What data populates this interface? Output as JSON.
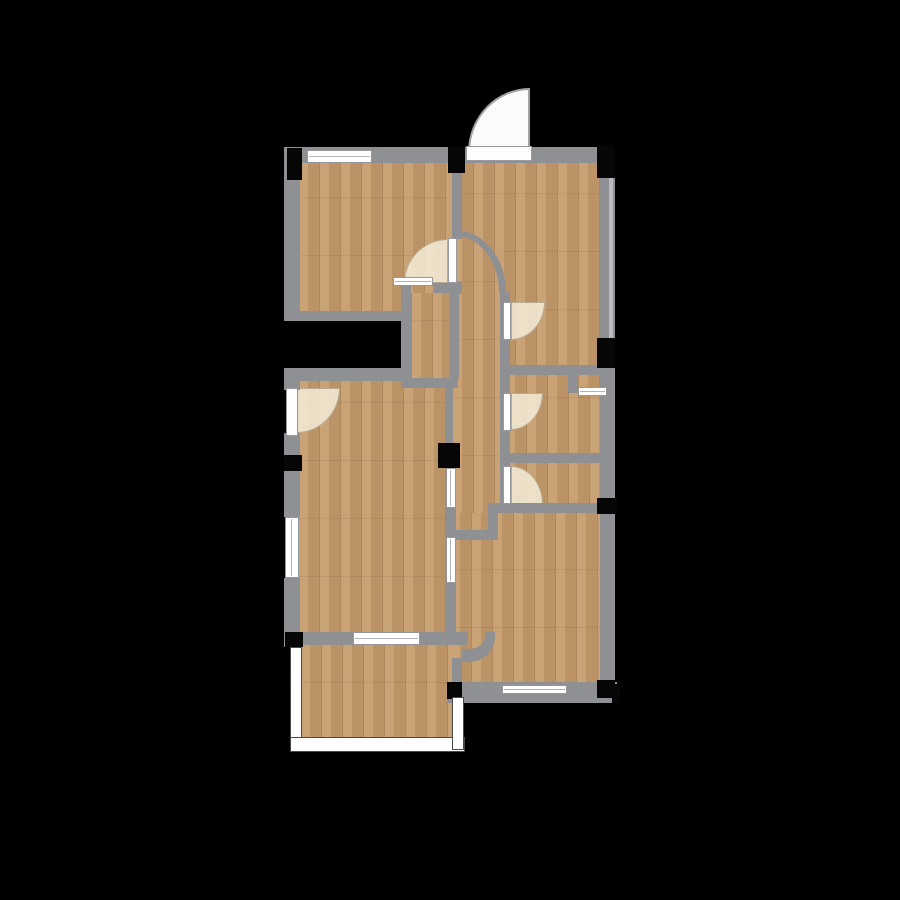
{
  "canvas": {
    "width": 900,
    "height": 900,
    "background": "#000000",
    "name": "floorplan-canvas"
  },
  "palette": {
    "floor_wood": "#c59b6c",
    "floor_plank_line": "#6e4824",
    "wall": "#8f9094",
    "wall_light": "#babbc1",
    "window_fill": "#ffffff",
    "window_frame": "#97979b",
    "door_leaf": "#fefefe",
    "door_swing": "#f3e9d5",
    "entry_swing": "#fbfbfb",
    "column": "#060607",
    "railing_fill": "#ffffff",
    "railing_edge": "#4a4a4a",
    "background": "#000000"
  },
  "floors": [
    {
      "name": "floor-room-top-left",
      "x": 298,
      "y": 163,
      "w": 154,
      "h": 150
    },
    {
      "name": "floor-room-top-right",
      "x": 452,
      "y": 163,
      "w": 150,
      "h": 204
    },
    {
      "name": "floor-closet-pocket",
      "x": 411,
      "y": 293,
      "w": 39,
      "h": 85
    },
    {
      "name": "floor-hallway",
      "x": 452,
      "y": 238,
      "w": 51,
      "h": 275
    },
    {
      "name": "floor-bath-upper",
      "x": 505,
      "y": 375,
      "w": 97,
      "h": 80
    },
    {
      "name": "floor-niche",
      "x": 578,
      "y": 373,
      "w": 26,
      "h": 16
    },
    {
      "name": "floor-bath-lower",
      "x": 505,
      "y": 462,
      "w": 97,
      "h": 41
    },
    {
      "name": "floor-living-room",
      "x": 298,
      "y": 380,
      "w": 150,
      "h": 254
    },
    {
      "name": "floor-bedroom-bottom",
      "x": 450,
      "y": 513,
      "w": 152,
      "h": 172
    },
    {
      "name": "floor-balcony",
      "x": 300,
      "y": 645,
      "w": 153,
      "h": 95
    }
  ],
  "door_swings": [
    {
      "name": "entry-door-swing",
      "x": 468,
      "y": 88,
      "w": 62,
      "h": 64,
      "corner": "tl",
      "variant": "white"
    },
    {
      "name": "door-swing-room-top-left",
      "x": 404,
      "y": 239,
      "w": 44,
      "h": 44,
      "corner": "tl"
    },
    {
      "name": "door-swing-hall-upper",
      "x": 511,
      "y": 302,
      "w": 34,
      "h": 38,
      "corner": "br"
    },
    {
      "name": "door-swing-bath-upper",
      "x": 511,
      "y": 393,
      "w": 32,
      "h": 37,
      "corner": "br"
    },
    {
      "name": "door-swing-bath-lower",
      "x": 511,
      "y": 466,
      "w": 32,
      "h": 38,
      "corner": "tr"
    },
    {
      "name": "door-swing-living-west",
      "x": 297,
      "y": 388,
      "w": 43,
      "h": 45,
      "corner": "br"
    }
  ],
  "arc_walls": [
    {
      "name": "curved-wall-hallway",
      "x": 455,
      "y": 230,
      "w": 51,
      "h": 62
    }
  ],
  "corner_arcs": [
    {
      "name": "curved-wall-corner-living",
      "x": 462,
      "y": 632,
      "w": 33,
      "h": 30
    }
  ],
  "walls": [
    {
      "name": "wall-top",
      "x": 284,
      "y": 147,
      "w": 323,
      "h": 16
    },
    {
      "name": "wall-left-upper",
      "x": 284,
      "y": 147,
      "w": 16,
      "h": 173
    },
    {
      "name": "wall-divider-upper",
      "x": 452,
      "y": 163,
      "w": 10,
      "h": 76
    },
    {
      "name": "wall-divider-lower",
      "x": 452,
      "y": 282,
      "w": 10,
      "h": 12
    },
    {
      "name": "wall-right",
      "x": 600,
      "y": 147,
      "w": 15,
      "h": 556
    },
    {
      "name": "wall-right-window-strip",
      "x": 609,
      "y": 178,
      "w": 4,
      "h": 160,
      "light": true
    },
    {
      "name": "wall-room-tl-bottom",
      "x": 284,
      "y": 311,
      "w": 126,
      "h": 10
    },
    {
      "name": "wall-pocket-left",
      "x": 401,
      "y": 283,
      "w": 10,
      "h": 105
    },
    {
      "name": "wall-pocket-top-stub",
      "x": 433,
      "y": 283,
      "w": 26,
      "h": 10
    },
    {
      "name": "wall-pocket-bottom",
      "x": 401,
      "y": 378,
      "w": 57,
      "h": 10
    },
    {
      "name": "wall-pocket-right",
      "x": 450,
      "y": 293,
      "w": 9,
      "h": 85
    },
    {
      "name": "wall-hallway-west",
      "x": 445,
      "y": 378,
      "w": 8,
      "h": 66
    },
    {
      "name": "wall-hallway-east",
      "x": 500,
      "y": 292,
      "w": 10,
      "h": 221
    },
    {
      "name": "wall-bath-top",
      "x": 510,
      "y": 365,
      "w": 97,
      "h": 10
    },
    {
      "name": "wall-niche-left",
      "x": 568,
      "y": 375,
      "w": 10,
      "h": 18
    },
    {
      "name": "wall-bath-divider",
      "x": 503,
      "y": 453,
      "w": 112,
      "h": 10
    },
    {
      "name": "wall-hallway-bottom",
      "x": 492,
      "y": 503,
      "w": 125,
      "h": 10
    },
    {
      "name": "wall-jog-vertical",
      "x": 488,
      "y": 503,
      "w": 10,
      "h": 32
    },
    {
      "name": "wall-jog-horizontal",
      "x": 452,
      "y": 530,
      "w": 46,
      "h": 10
    },
    {
      "name": "wall-westline-seg1",
      "x": 446,
      "y": 508,
      "w": 10,
      "h": 29
    },
    {
      "name": "wall-westline-seg2",
      "x": 446,
      "y": 583,
      "w": 10,
      "h": 49
    },
    {
      "name": "wall-living-top",
      "x": 284,
      "y": 368,
      "w": 127,
      "h": 13
    },
    {
      "name": "wall-living-west-a",
      "x": 284,
      "y": 368,
      "w": 16,
      "h": 22
    },
    {
      "name": "wall-living-west-b",
      "x": 284,
      "y": 433,
      "w": 16,
      "h": 84
    },
    {
      "name": "wall-living-west-c",
      "x": 284,
      "y": 578,
      "w": 16,
      "h": 69
    },
    {
      "name": "wall-living-bottom-a",
      "x": 298,
      "y": 632,
      "w": 55,
      "h": 13
    },
    {
      "name": "wall-living-bottom-b",
      "x": 420,
      "y": 632,
      "w": 48,
      "h": 13
    },
    {
      "name": "wall-balcony-right",
      "x": 452,
      "y": 658,
      "w": 10,
      "h": 27
    },
    {
      "name": "wall-bedroom-bottom-band",
      "x": 447,
      "y": 682,
      "w": 170,
      "h": 21
    }
  ],
  "windows": [
    {
      "name": "window-top",
      "x": 307,
      "y": 150,
      "w": 65,
      "h": 13
    },
    {
      "name": "window-pocket",
      "x": 393,
      "y": 277,
      "w": 40,
      "h": 9
    },
    {
      "name": "window-living-west",
      "x": 285,
      "y": 517,
      "w": 14,
      "h": 61
    },
    {
      "name": "window-living-south",
      "x": 353,
      "y": 632,
      "w": 67,
      "h": 13
    },
    {
      "name": "window-niche",
      "x": 578,
      "y": 387,
      "w": 29,
      "h": 9
    },
    {
      "name": "window-interior-a",
      "x": 446,
      "y": 468,
      "w": 10,
      "h": 40
    },
    {
      "name": "window-interior-b",
      "x": 446,
      "y": 537,
      "w": 10,
      "h": 46
    },
    {
      "name": "window-bedroom-south",
      "x": 502,
      "y": 685,
      "w": 65,
      "h": 9
    }
  ],
  "door_leaves": [
    {
      "name": "entry-door-leaf",
      "x": 466,
      "y": 146,
      "w": 66,
      "h": 15
    },
    {
      "name": "door-leaf-room-top-left",
      "x": 448,
      "y": 238,
      "w": 9,
      "h": 45
    },
    {
      "name": "door-leaf-hall-upper",
      "x": 503,
      "y": 302,
      "w": 8,
      "h": 38
    },
    {
      "name": "door-leaf-bath-upper",
      "x": 503,
      "y": 393,
      "w": 8,
      "h": 38
    },
    {
      "name": "door-leaf-bath-lower",
      "x": 503,
      "y": 466,
      "w": 8,
      "h": 38
    },
    {
      "name": "door-leaf-living-west",
      "x": 286,
      "y": 388,
      "w": 12,
      "h": 48
    }
  ],
  "columns": [
    {
      "name": "column-top-left",
      "x": 287,
      "y": 148,
      "w": 15,
      "h": 32
    },
    {
      "name": "column-top-mid",
      "x": 448,
      "y": 147,
      "w": 17,
      "h": 26
    },
    {
      "name": "column-top-right",
      "x": 597,
      "y": 145,
      "w": 18,
      "h": 33
    },
    {
      "name": "column-right-mid",
      "x": 597,
      "y": 338,
      "w": 18,
      "h": 30
    },
    {
      "name": "column-right-lower",
      "x": 597,
      "y": 498,
      "w": 20,
      "h": 16
    },
    {
      "name": "column-center",
      "x": 438,
      "y": 443,
      "w": 22,
      "h": 25
    },
    {
      "name": "column-left-mid",
      "x": 284,
      "y": 455,
      "w": 18,
      "h": 16
    },
    {
      "name": "column-left-lower",
      "x": 285,
      "y": 632,
      "w": 18,
      "h": 15
    },
    {
      "name": "column-bedroom-sw",
      "x": 447,
      "y": 682,
      "w": 15,
      "h": 17
    },
    {
      "name": "column-bedroom-se",
      "x": 597,
      "y": 680,
      "w": 18,
      "h": 18
    },
    {
      "name": "column-bedroom-se-edge",
      "x": 612,
      "y": 684,
      "w": 8,
      "h": 19
    }
  ],
  "railings": [
    {
      "name": "balcony-railing-west",
      "x": 290,
      "y": 647,
      "w": 12,
      "h": 98
    },
    {
      "name": "balcony-railing-south",
      "x": 290,
      "y": 737,
      "w": 175,
      "h": 15
    },
    {
      "name": "balcony-railing-east",
      "x": 452,
      "y": 697,
      "w": 12,
      "h": 53
    }
  ]
}
